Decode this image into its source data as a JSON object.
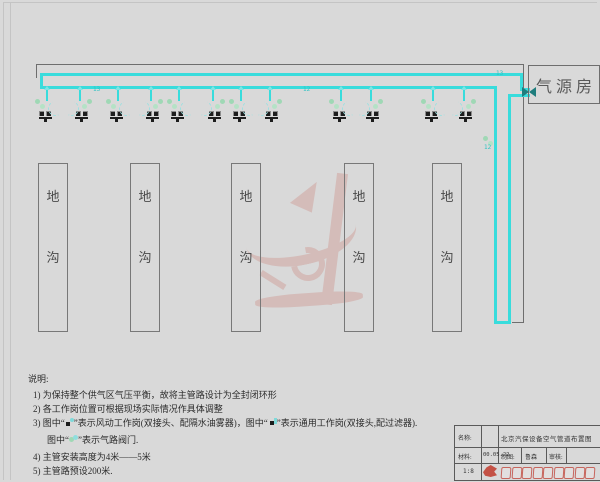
{
  "colors": {
    "background": "#d9d9d9",
    "pipe": "#38dcdc",
    "pale_cyan": "#9fe0e0",
    "valve_green": "#9fd8b5",
    "outline_gray": "#6e6e6e",
    "watermark_red": "#c4584b",
    "logo_red": "#c0392b"
  },
  "diagram": {
    "air_source_room": {
      "label": "气源房"
    },
    "trench_label": "地沟",
    "trenches": [
      {
        "x": 38
      },
      {
        "x": 130
      },
      {
        "x": 231
      },
      {
        "x": 344
      },
      {
        "x": 432
      }
    ],
    "stations": [
      {
        "x": 46,
        "type": "风动工作岗"
      },
      {
        "x": 79,
        "type": "通用工作岗"
      },
      {
        "x": 117,
        "type": "风动工作岗"
      },
      {
        "x": 150,
        "type": "通用工作岗"
      },
      {
        "x": 178,
        "type": "风动工作岗"
      },
      {
        "x": 212,
        "type": "通用工作岗"
      },
      {
        "x": 240,
        "type": "风动工作岗"
      },
      {
        "x": 269,
        "type": "通用工作岗"
      },
      {
        "x": 340,
        "type": "风动工作岗"
      },
      {
        "x": 370,
        "type": "通用工作岗"
      },
      {
        "x": 432,
        "type": "风动工作岗"
      },
      {
        "x": 463,
        "type": "通用工作岗"
      }
    ],
    "pipe_labels": [
      {
        "text": "13",
        "x": 93,
        "y": 86
      },
      {
        "text": "12",
        "x": 303,
        "y": 86
      },
      {
        "text": "13",
        "x": 496,
        "y": 70
      },
      {
        "text": "12",
        "x": 484,
        "y": 144
      }
    ],
    "icons": {
      "inlet_valve": "bowtie-valve-icon",
      "line_valve": "valve-icon",
      "watermark": "dragon-watermark"
    }
  },
  "notes": {
    "heading": "说明:",
    "items": [
      {
        "text": "1) 为保持整个供气区气压平衡，故将主管路设计为全封闭环形"
      },
      {
        "text": "2) 各工作岗位置可根据现场实际情况作具体调整"
      },
      {
        "segments": [
          {
            "t": "3) 图中“"
          },
          {
            "icon": "wind-station-icon"
          },
          {
            "t": "”表示风动工作岗(双接头、配隔水油雾器)，图中“"
          },
          {
            "icon": "general-station-icon"
          },
          {
            "t": "”表示通用工作岗(双接头,配过滤器)."
          }
        ]
      },
      {
        "indent": true,
        "segments": [
          {
            "t": "图中“"
          },
          {
            "icon": "valve-icon"
          },
          {
            "t": "”表示气路阀门."
          }
        ]
      },
      {
        "text": "4) 主管安装高度为4米——5米"
      },
      {
        "text": "5) 主管路预设200米."
      }
    ]
  },
  "title_block": {
    "name_label": "名称:",
    "drawing_title": "北京汽保设备空气管道布置图",
    "material_label": "材料:",
    "date": "00.05.22",
    "draft_label": "制图:",
    "draft_name": "鲁森",
    "review_label": "审核:",
    "scale": "1:8",
    "logo_glyph_count": 9
  }
}
